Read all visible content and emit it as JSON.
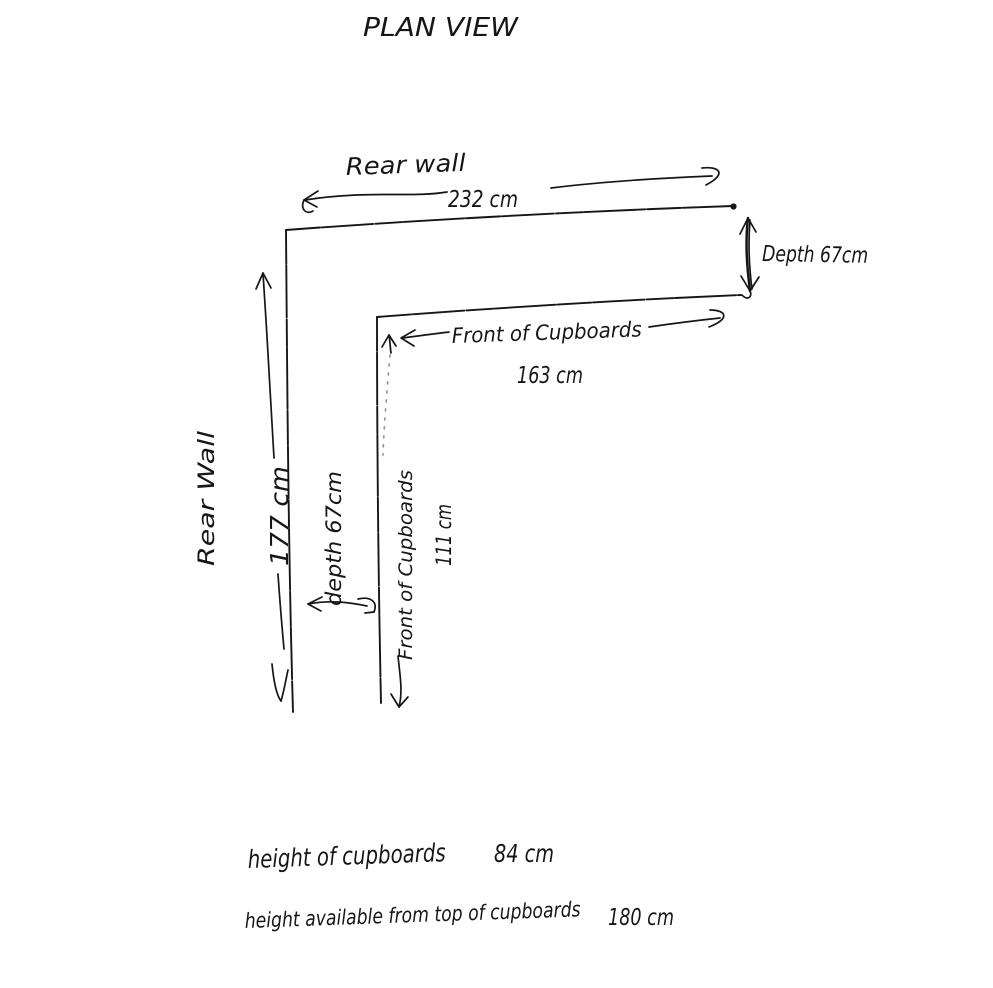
{
  "title": "PLAN VIEW",
  "colors": {
    "ink": "#161616",
    "paper": "#ffffff"
  },
  "annotations": {
    "rear_wall_top": {
      "label": "Rear wall",
      "dimension": "232 cm"
    },
    "depth_right": {
      "label": "Depth 67cm"
    },
    "front_top": {
      "label": "Front of Cupboards",
      "dimension": "163 cm"
    },
    "rear_wall_left": {
      "label": "Rear Wall",
      "dimension": "177 cm"
    },
    "depth_left": {
      "label": "depth 67cm"
    },
    "front_left": {
      "label": "Front of Cupboards",
      "dimension": "111 cm"
    }
  },
  "notes": [
    {
      "label": "height of cupboards",
      "value": "84 cm"
    },
    {
      "label": "height available from top of cupboards",
      "value": "180 cm"
    }
  ]
}
